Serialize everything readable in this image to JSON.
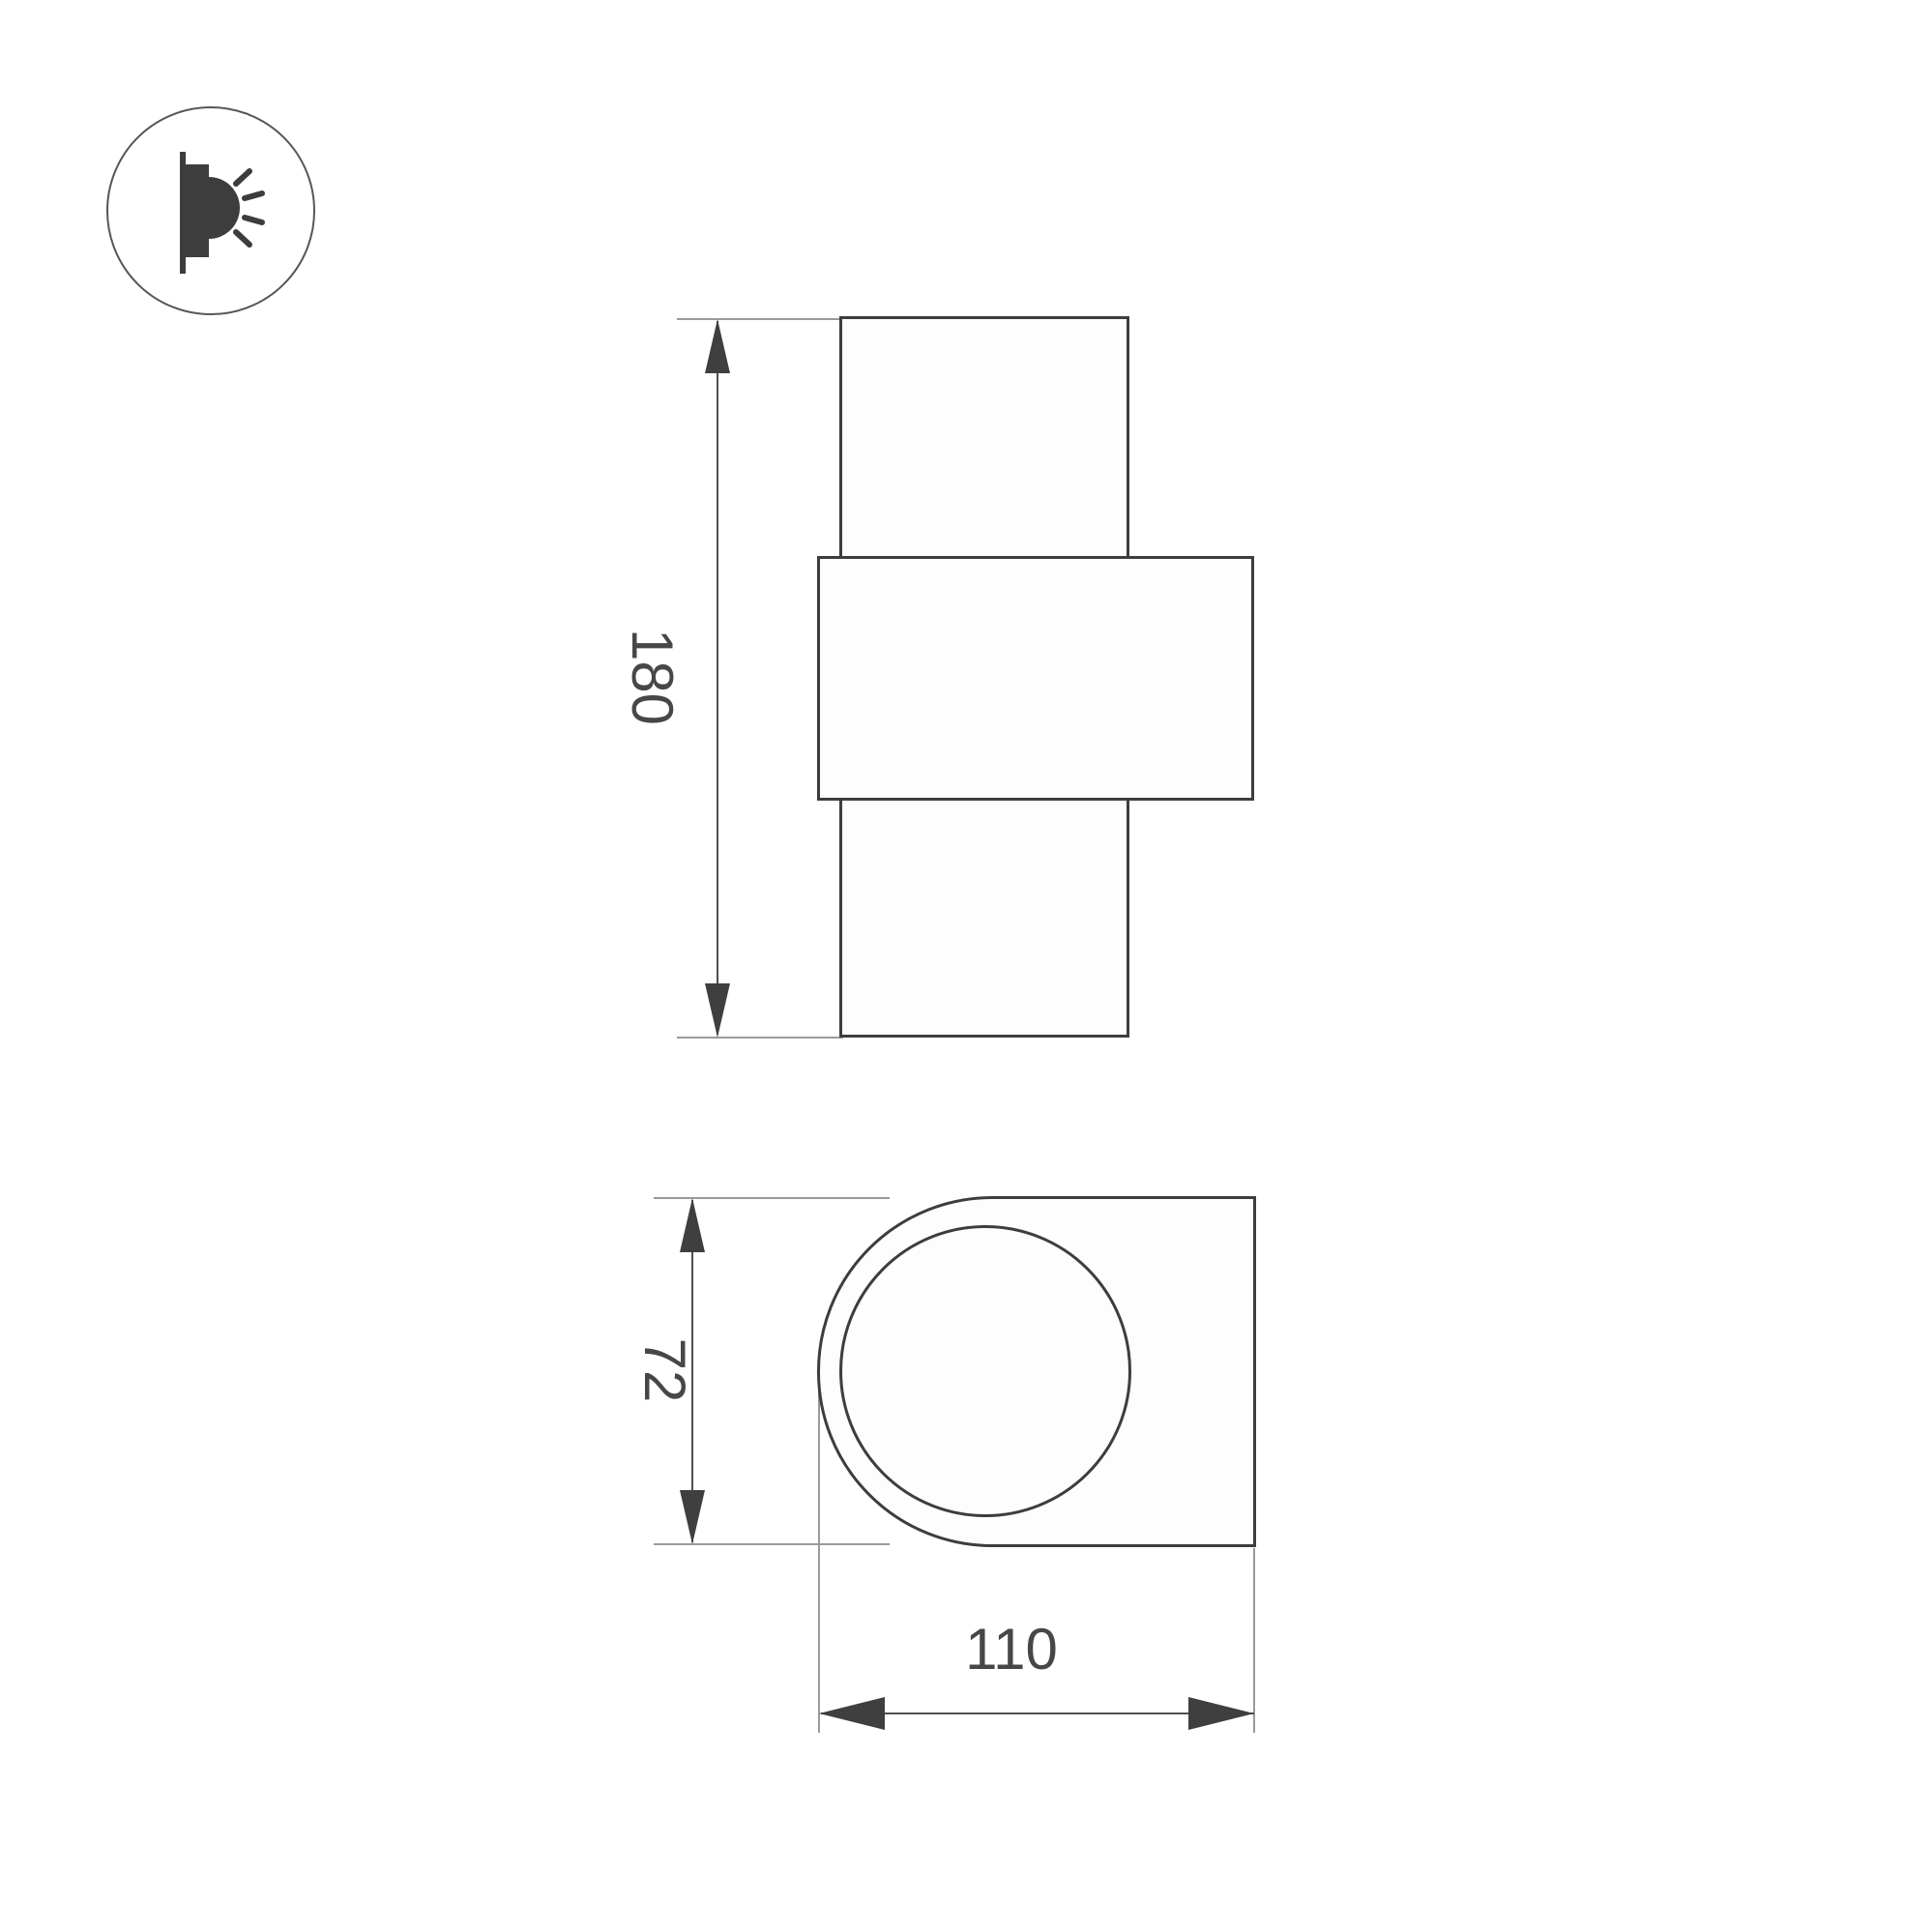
{
  "colors": {
    "background": "#ffffff",
    "outline": "#3d3d3d",
    "dimension_line": "#4f4f4f",
    "extension_line": "#9a9a9a",
    "text": "#474747",
    "icon_stroke": "#565656",
    "icon_glyph": "#3d3d3d"
  },
  "icon": {
    "name": "wall-light-side-emission-icon"
  },
  "dimensions": {
    "height": {
      "label": "180"
    },
    "depth": {
      "label": "72"
    },
    "width": {
      "label": "110"
    }
  }
}
